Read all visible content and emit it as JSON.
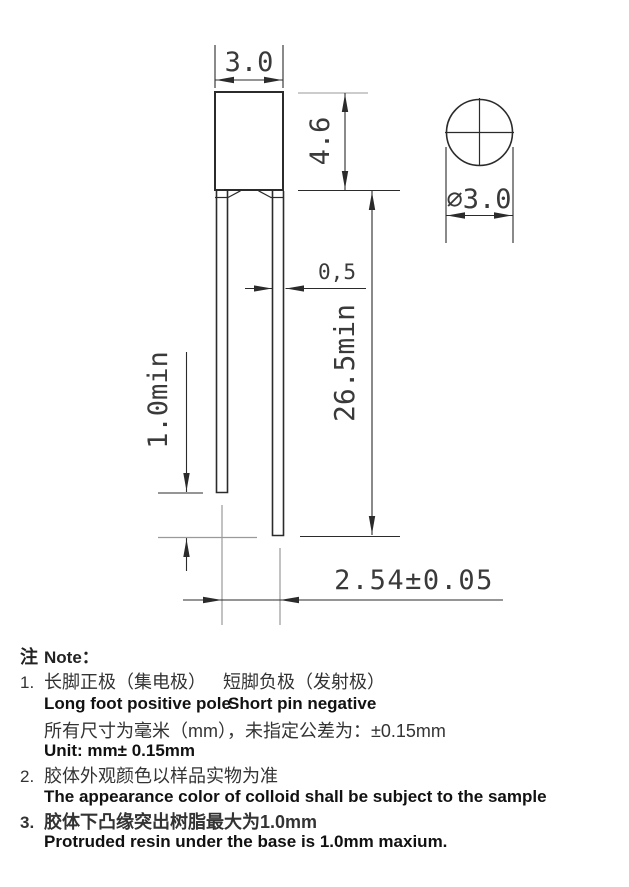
{
  "drawing": {
    "dims": {
      "body_width": "3.0",
      "body_height": "4.6",
      "lens_diameter": "∅3.0",
      "pin_width": "0,5",
      "pin_length_min": "26.5min",
      "standoff_min": "1.0min",
      "pin_pitch": "2.54±0.05"
    },
    "colors": {
      "line": "#2b2b2b",
      "gray_line": "#9a9a9a",
      "dim_text": "#3a3a3a"
    }
  },
  "notes": {
    "header_zh": "注",
    "header_en": "Note：",
    "item1_num": "1.",
    "item1_zh_a": "长脚正极（集电极）",
    "item1_zh_b": "短脚负极（发射极）",
    "item1_en_a": "Long foot positive pole",
    "item1_en_b": "Short pin negative",
    "item1_zh2": "所有尺寸为毫米（mm），未指定公差为：±0.15mm",
    "item1_unit": "Unit: mm± 0.15mm",
    "item2_num": "2.",
    "item2_zh": "胶体外观颜色以样品实物为准",
    "item2_en": "The appearance color of colloid shall be subject to the sample",
    "item3_num": "3.",
    "item3_zh": "胶体下凸缘突出树脂最大为1.0mm",
    "item3_en": "Protruded resin under the base is 1.0mm maxium."
  }
}
